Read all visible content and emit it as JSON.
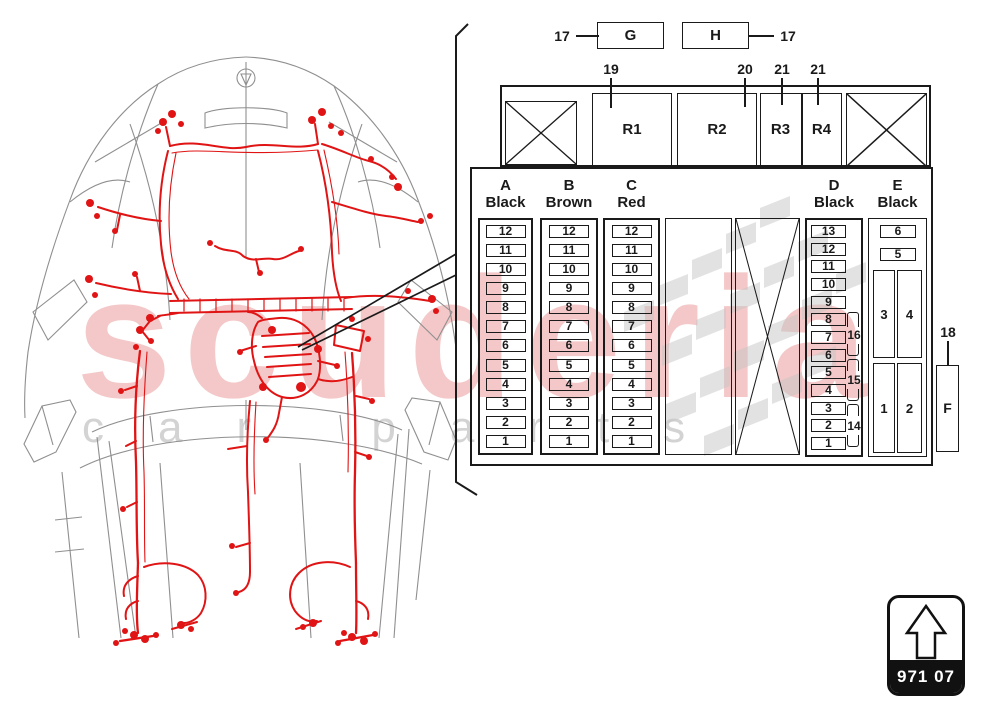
{
  "watermark": {
    "brand": "scuderia",
    "tagline": "car parts"
  },
  "top_row": {
    "left_ref": "17",
    "right_ref": "17",
    "boxes": [
      {
        "label": "G"
      },
      {
        "label": "H"
      }
    ]
  },
  "relay_row": {
    "refs": [
      "19",
      "20",
      "21",
      "21"
    ],
    "relays": [
      {
        "label": "R1"
      },
      {
        "label": "R2"
      },
      {
        "label": "R3"
      },
      {
        "label": "R4"
      }
    ]
  },
  "fuse_panel": {
    "columns": [
      {
        "letter": "A",
        "color": "Black",
        "fuses": [
          "12",
          "11",
          "10",
          "9",
          "8",
          "7",
          "6",
          "5",
          "4",
          "3",
          "2",
          "1"
        ]
      },
      {
        "letter": "B",
        "color": "Brown",
        "fuses": [
          "12",
          "11",
          "10",
          "9",
          "8",
          "7",
          "6",
          "5",
          "4",
          "3",
          "2",
          "1"
        ]
      },
      {
        "letter": "C",
        "color": "Red",
        "fuses": [
          "12",
          "11",
          "10",
          "9",
          "8",
          "7",
          "6",
          "5",
          "4",
          "3",
          "2",
          "1"
        ]
      },
      {
        "letter": "D",
        "color": "Black",
        "fuses": [
          "13",
          "12",
          "11",
          "10",
          "9",
          "8",
          "7",
          "6",
          "5",
          "4",
          "3",
          "2",
          "1"
        ],
        "group_refs": [
          "16",
          "15",
          "14"
        ]
      },
      {
        "letter": "E",
        "color": "Black",
        "small_fuses": [
          "6",
          "5"
        ],
        "slots": [
          "3",
          "4",
          "1",
          "2"
        ]
      }
    ],
    "aux_box": {
      "label": "F",
      "ref": "18"
    }
  },
  "part_badge": {
    "code": "971 07"
  }
}
